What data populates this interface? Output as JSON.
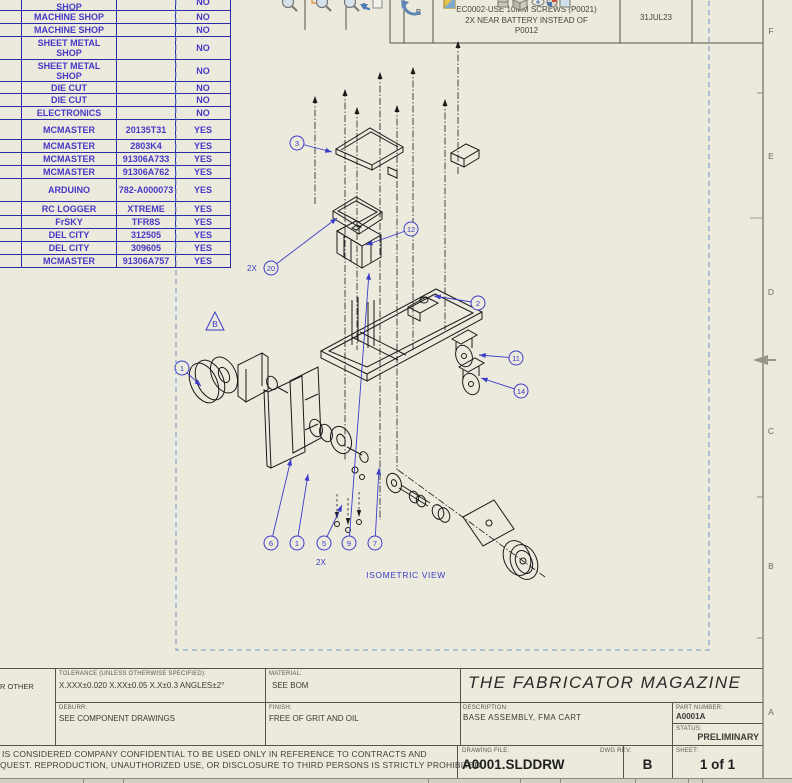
{
  "colors": {
    "paper": "#ECEADC",
    "bom_line": "#2B2BA8",
    "bom_text": "#4638C8",
    "annotation_blue": "#3C3CC8",
    "art_black": "#1A1A1A",
    "dashed_border": "#6E96C8",
    "title_line": "#55534B"
  },
  "bom_table": {
    "rows": [
      {
        "vendor": "SHEET METAL SHOP",
        "part": "",
        "make": "NO"
      },
      {
        "vendor": "MACHINE SHOP",
        "part": "",
        "make": "NO"
      },
      {
        "vendor": "MACHINE SHOP",
        "part": "",
        "make": "NO"
      },
      {
        "vendor": "SHEET METAL SHOP",
        "part": "",
        "make": "NO"
      },
      {
        "vendor": "SHEET METAL SHOP",
        "part": "",
        "make": "NO"
      },
      {
        "vendor": "DIE CUT",
        "part": "",
        "make": "NO"
      },
      {
        "vendor": "DIE CUT",
        "part": "",
        "make": "NO"
      },
      {
        "vendor": "ELECTRONICS",
        "part": "",
        "make": "NO"
      },
      {
        "vendor": "MCMASTER",
        "part": "20135T31",
        "make": "YES"
      },
      {
        "vendor": "MCMASTER",
        "part": "2803K4",
        "make": "YES"
      },
      {
        "vendor": "MCMASTER",
        "part": "91306A733",
        "make": "YES"
      },
      {
        "vendor": "MCMASTER",
        "part": "91306A762",
        "make": "YES"
      },
      {
        "vendor": "ARDUINO",
        "part": "782-A000073",
        "make": "YES"
      },
      {
        "vendor": "RC LOGGER",
        "part": "XTREME",
        "make": "YES"
      },
      {
        "vendor": "FrSKY",
        "part": "TFR8S",
        "make": "YES"
      },
      {
        "vendor": "DEL CITY",
        "part": "312505",
        "make": "YES"
      },
      {
        "vendor": "DEL CITY",
        "part": "309605",
        "make": "YES"
      },
      {
        "vendor": "MCMASTER",
        "part": "91306A757",
        "make": "YES"
      }
    ]
  },
  "revision_table": {
    "rev": "B",
    "description_lines": [
      "EC0002-USE 10MM SCREWS (P0021)",
      "2X NEAR BATTERY INSTEAD OF",
      "P0012"
    ],
    "date": "31JUL23",
    "approved": ""
  },
  "toolbar": {
    "icons": [
      "zoom-fit-icon",
      "zoom-area-icon",
      "zoom-in-out-icon",
      "previous-view-icon",
      "rotate-view-icon",
      "section-view-icon",
      "view-orientation-icon",
      "display-style-icon",
      "hide-show-icon",
      "appearances-icon",
      "scene-icon"
    ]
  },
  "view": {
    "label": "ISOMETRIC VIEW",
    "rev_flag": "B",
    "balloons": [
      {
        "n": "3",
        "x": 297,
        "y": 143,
        "tx": 332,
        "ty": 152
      },
      {
        "n": "12",
        "x": 411,
        "y": 229,
        "tx": 366,
        "ty": 245
      },
      {
        "n": "20",
        "x": 271,
        "y": 268,
        "tx": 337,
        "ty": 218
      },
      {
        "n": "2",
        "x": 478,
        "y": 303,
        "tx": 434,
        "ty": 296
      },
      {
        "n": "11",
        "x": 516,
        "y": 358,
        "tx": 479,
        "ty": 355
      },
      {
        "n": "14",
        "x": 521,
        "y": 391,
        "tx": 481,
        "ty": 378
      },
      {
        "n": "1",
        "x": 182,
        "y": 368,
        "tx": 201,
        "ty": 386
      },
      {
        "n": "6",
        "x": 271,
        "y": 543,
        "tx": 291,
        "ty": 459
      },
      {
        "n": "1",
        "x": 297,
        "y": 543,
        "tx": 308,
        "ty": 474
      },
      {
        "n": "5",
        "x": 324,
        "y": 543,
        "tx": 342,
        "ty": 505
      },
      {
        "n": "9",
        "x": 349,
        "y": 543,
        "tx": 369,
        "ty": 273
      },
      {
        "n": "7",
        "x": 375,
        "y": 543,
        "tx": 379,
        "ty": 468
      }
    ],
    "qty_notes": [
      {
        "text": "2X",
        "x": 247,
        "y": 271
      },
      {
        "text": "2X",
        "x": 316,
        "y": 565
      }
    ]
  },
  "zones": {
    "right_letters": [
      "F",
      "E",
      "D",
      "C",
      "B",
      "A"
    ]
  },
  "title_block": {
    "left_fragment": "R OTHER",
    "tolerance_label": "TOLERANCE (UNLESS OTHERWISE SPECIFIED):",
    "tolerance_value": "X.XXX±0.020 X.XX±0.05 X.X±0.3 ANGLES±2°",
    "deburr_label": "DEBURR:",
    "deburr_value": "SEE COMPONENT DRAWINGS",
    "material_label": "MATERIAL:",
    "material_value": "SEE BOM",
    "finish_label": "FINISH:",
    "finish_value": "FREE OF GRIT AND OIL",
    "company": "THE FABRICATOR MAGAZINE",
    "description_label": "DESCRIPTION:",
    "description_value": "BASE ASSEMBLY, FMA CART",
    "part_number_label": "PART NUMBER:",
    "part_number_value": "A0001A",
    "status_label": "STATUS:",
    "status_value": "PRELIMINARY",
    "drawing_file_label": "DRAWING FILE:",
    "drawing_file_value": "A0001.SLDDRW",
    "dwg_rev_label": "DWG REV:",
    "dwg_rev_value": "B",
    "sheet_label": "SHEET:",
    "sheet_value": "1 of 1"
  },
  "footer": {
    "confidential_line1": "IS CONSIDERED COMPANY CONFIDENTIAL TO BE USED ONLY IN REFERENCE TO CONTRACTS AND",
    "confidential_line2": "QUEST.  REPRODUCTION, UNAUTHORIZED USE, OR DISCLOSURE TO THIRD PERSONS IS STRICTLY PROHIBITED."
  }
}
